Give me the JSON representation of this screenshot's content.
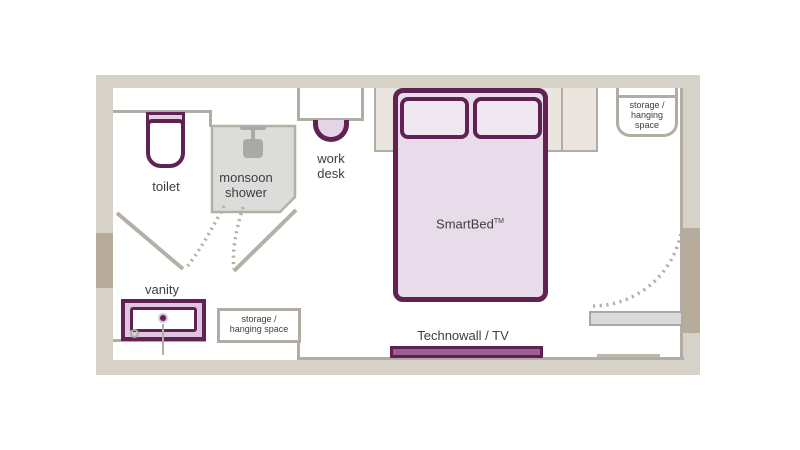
{
  "labels": {
    "toilet": "toilet",
    "shower_line1": "monsoon",
    "shower_line2": "shower",
    "desk_line1": "work",
    "desk_line2": "desk",
    "bed_name": "SmartBed",
    "bed_tm": "TM",
    "storage_top_line1": "storage /",
    "storage_top_line2": "hanging",
    "storage_top_line3": "space",
    "vanity": "vanity",
    "storage_bottom_line1": "storage /",
    "storage_bottom_line2": "hanging space",
    "technowall": "Technowall / TV"
  },
  "colors": {
    "purple_dark": "#602253",
    "bed_fill": "#e9dcea",
    "pillow_fill": "#f0e8f1",
    "vanity_fill": "#dfc6e0",
    "technowall_fill": "#9a6190",
    "wall": "#d7d2c8",
    "wall_dark": "#b7ac9c",
    "line_gray": "#b2ada2",
    "shower_fill": "#dcdcda",
    "headboard_fill": "#eae6df",
    "door_panel_fill": "#dadada",
    "text": "#3d3d3d"
  }
}
